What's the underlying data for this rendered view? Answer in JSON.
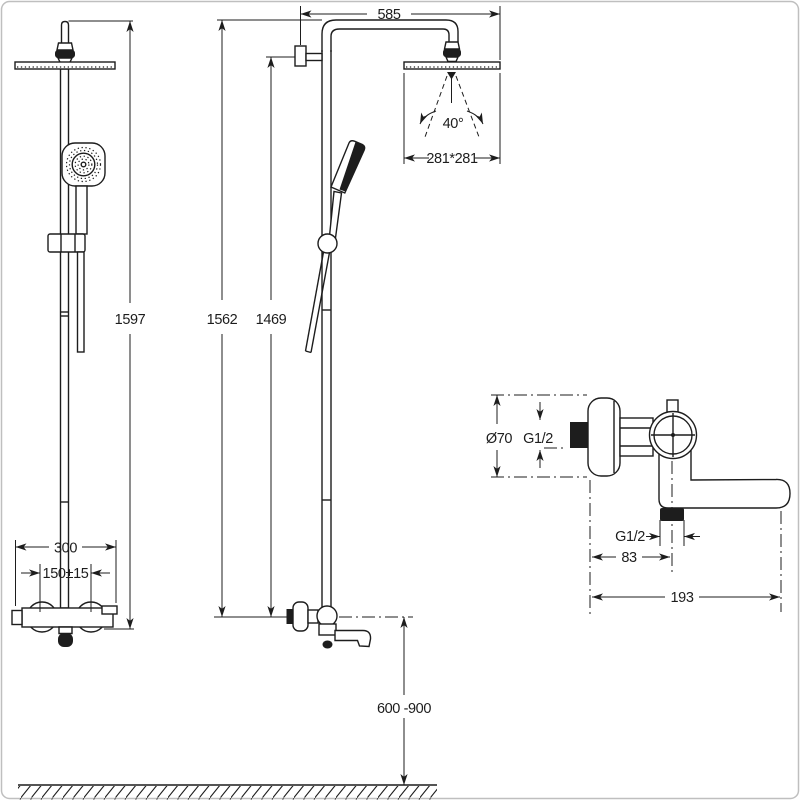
{
  "drawing_type": "shower-system-installation-drawing",
  "colors": {
    "line": "#1d1d1d",
    "background": "#ffffff",
    "frame": "#bfbfbf",
    "solid_fill": "#1d1d1d"
  },
  "views": {
    "front": {
      "overall_height": "1597",
      "mixer_width": "300",
      "inlet_spacing": "150±15"
    },
    "side": {
      "arm_reach": "585",
      "spray_angle": "40°",
      "head_size": "281*281",
      "column_height": "1562",
      "bracket_height": "1469",
      "install_height": "600 -900"
    },
    "detail": {
      "flange_diameter": "Ø70",
      "inlet_thread": "G1/2",
      "outlet_thread": "G1/2",
      "outlet_offset": "83",
      "spout_reach": "193"
    }
  }
}
